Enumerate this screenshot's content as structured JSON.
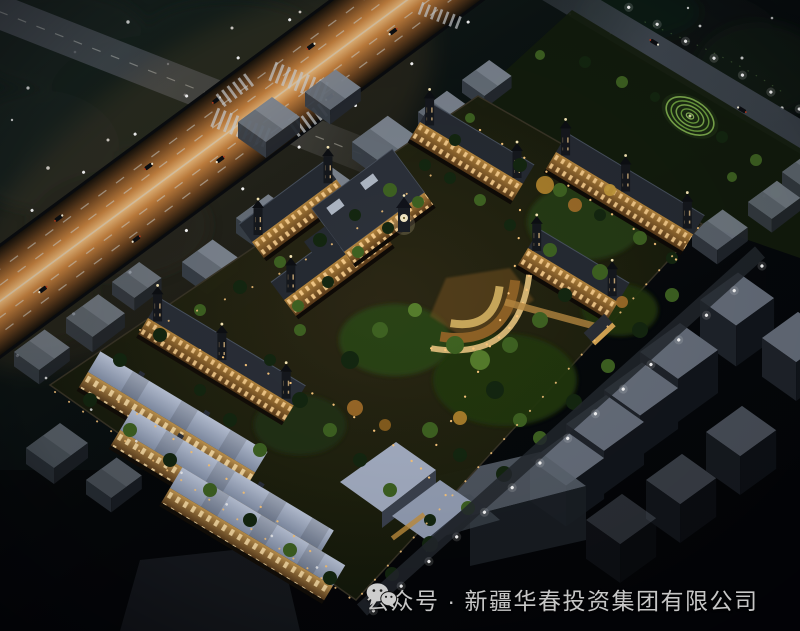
{
  "caption": {
    "icon": "wechat",
    "text": "公众号 · 新疆华春投资集团有限公司"
  },
  "colors": {
    "sky_dark": "#05080c",
    "sky_teal": "#18241e",
    "road_glow": "#e09a4e",
    "road_core": "#f2c88c",
    "lane_mark": "#d9dcd6",
    "context_roof": "#79828e",
    "context_wall": "#262b33",
    "site_ground": "#1c2012",
    "tree_dark": "#142710",
    "tree_lit": "#3f6322",
    "roof_blue": "#9fabc4",
    "facade_amber": "#c2924e",
    "window_lit": "#ffd795",
    "plaza_amber": "#c08a3a",
    "lamp_white": "#ffffff",
    "path_light": "#ffca7e",
    "caption_text": "#c6c6c6"
  }
}
